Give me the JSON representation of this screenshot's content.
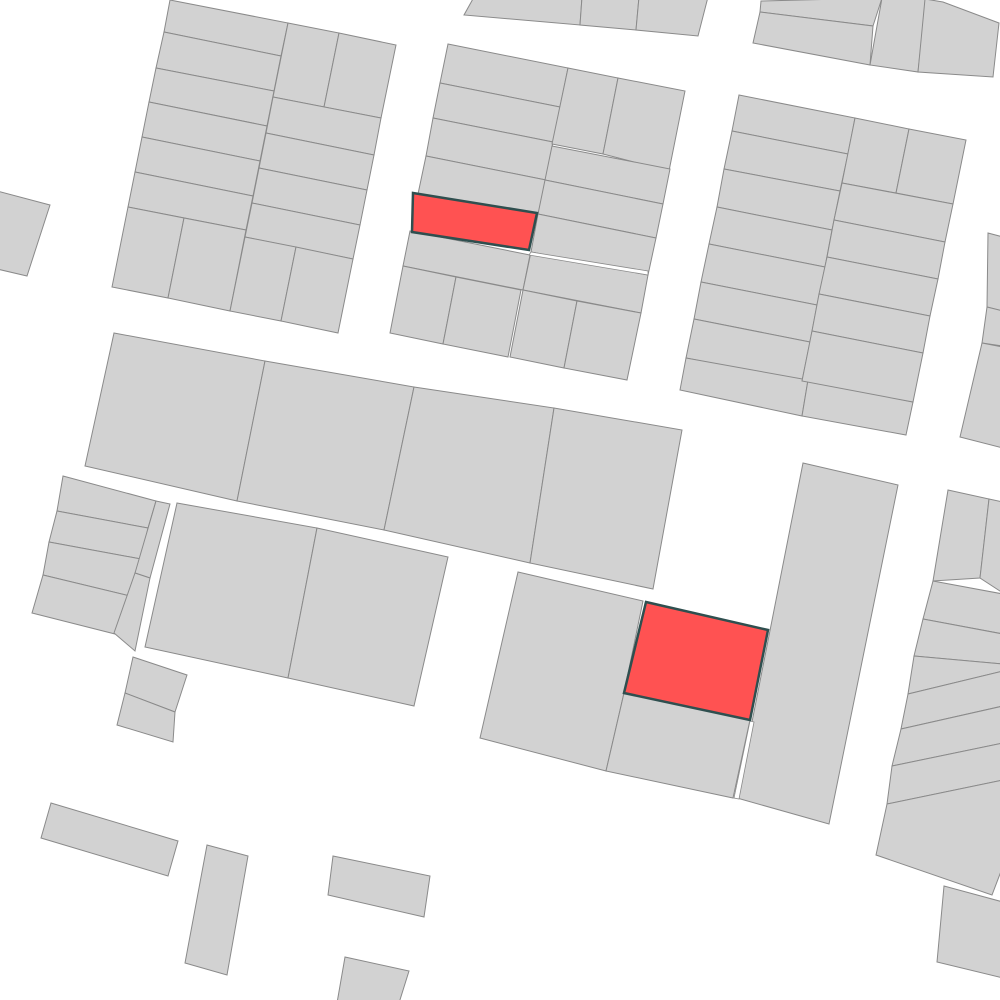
{
  "map": {
    "background": "#ffffff",
    "canvas": {
      "width": 1000,
      "height": 1000
    },
    "parcel_style": {
      "fill": "#d2d2d2",
      "stroke": "#8a8a8a",
      "stroke_width": 1
    },
    "highlight_style": {
      "fill": "#ff5252",
      "stroke": "#2f4f4f",
      "stroke_width": 2.5
    },
    "gap_style": {
      "fill": "#ffffff",
      "stroke": "#8a8a8a",
      "stroke_width": 0.8
    },
    "parcels": [
      {
        "points": "170,0 288,23 281,56 164,32"
      },
      {
        "points": "164,32 281,56 274,91 156,68"
      },
      {
        "points": "156,68 274,91 267,126 149,102"
      },
      {
        "points": "149,102 267,126 260,161 142,137"
      },
      {
        "points": "142,137 260,161 253,196 135,172"
      },
      {
        "points": "135,172 253,196 246,230 128,207"
      },
      {
        "points": "128,207 184,218 168,298 112,287"
      },
      {
        "points": "184,218 246,230 230,311 168,298"
      },
      {
        "points": "288,23 339,33 324,107 273,97"
      },
      {
        "points": "339,33 396,45 381,118 324,107"
      },
      {
        "points": "273,97 381,118 374,155 266,133"
      },
      {
        "points": "266,133 374,155 367,190 259,168"
      },
      {
        "points": "259,168 367,190 360,225 252,203"
      },
      {
        "points": "252,203 360,225 353,259 245,237"
      },
      {
        "points": "245,237 296,247 281,321 230,311"
      },
      {
        "points": "296,247 353,259 338,333 281,321"
      },
      {
        "points": "448,44 568,68 560,107 440,83"
      },
      {
        "points": "440,83 560,107 553,142 433,118"
      },
      {
        "points": "433,118 553,142 546,180 426,156"
      },
      {
        "points": "426,156 546,180 538,218 418,194"
      },
      {
        "points": "410,231 530,255 523,290 403,266"
      },
      {
        "points": "403,266 456,277 443,344 390,333"
      },
      {
        "points": "456,277 521,290 508,357 443,344"
      },
      {
        "points": "568,68 618,78 603,154 552,144"
      },
      {
        "points": "618,78 685,91 669,171 603,154"
      },
      {
        "points": "552,146 670,169 663,204 545,180"
      },
      {
        "points": "545,180 663,204 656,238 538,214"
      },
      {
        "points": "538,214 656,238 648,275 531,252"
      },
      {
        "points": "531,252 648,275 641,313 523,290"
      },
      {
        "points": "523,290 577,301 564,368 510,357"
      },
      {
        "points": "577,301 641,313 627,380 564,368"
      },
      {
        "points": "739,95 855,118 848,154 732,131"
      },
      {
        "points": "732,131 848,154 840,191 724,169"
      },
      {
        "points": "724,169 840,191 832,230 717,207"
      },
      {
        "points": "717,207 832,230 825,267 709,244"
      },
      {
        "points": "709,244 825,267 817,305 701,282"
      },
      {
        "points": "701,282 817,305 810,342 694,319"
      },
      {
        "points": "694,319 810,342 802,381 686,358"
      },
      {
        "points": "686,358 808,380 802,416 680,390"
      },
      {
        "points": "808,380 913,402 906,435 802,416"
      },
      {
        "points": "855,118 909,129 896,193 842,183"
      },
      {
        "points": "909,129 966,140 953,204 896,193"
      },
      {
        "points": "842,183 953,204 945,242 834,220"
      },
      {
        "points": "834,220 945,242 938,279 827,257"
      },
      {
        "points": "827,257 938,279 930,316 819,294"
      },
      {
        "points": "819,294 930,316 923,353 812,331"
      },
      {
        "points": "812,331 923,353 913,402 802,381"
      },
      {
        "points": "761,1 882,-2 873,26 760,12"
      },
      {
        "points": "760,12 873,26 870,65 753,43"
      },
      {
        "points": "882,-2 926,-2 918,72 870,65"
      },
      {
        "points": "925,-1 943,2 999,23 993,77 918,72"
      },
      {
        "points": "474,-3 582,-3 580,25 464,15"
      },
      {
        "points": "582,-3 639,-3 636,30 580,25"
      },
      {
        "points": "639,-3 708,-3 698,36 636,30"
      },
      {
        "points": "114,333 265,361 237,501 85,466"
      },
      {
        "points": "265,361 414,387 384,530 237,501"
      },
      {
        "points": "414,387 554,408 530,563 384,530"
      },
      {
        "points": "554,408 682,430 653,589 530,563"
      },
      {
        "points": "63,476 156,501 148,528 57,511"
      },
      {
        "points": "57,511 148,528 141,559 49,542"
      },
      {
        "points": "49,542 141,559 130,596 43,575"
      },
      {
        "points": "43,575 130,596 115,634 32,613"
      },
      {
        "points": "156,501 170,504 150,578 135,573"
      },
      {
        "points": "135,573 150,578 135,651 114,633"
      },
      {
        "points": "177,503 317,528 288,678 145,647"
      },
      {
        "points": "317,528 448,557 414,706 288,678"
      },
      {
        "points": "133,657 187,675 175,712 125,693"
      },
      {
        "points": "125,693 175,712 173,742 117,725"
      },
      {
        "points": "-3,191 50,205 27,276 -3,269"
      },
      {
        "points": "518,572 643,601 624,693 606,771 480,738"
      },
      {
        "points": "624,693 750,720 733,798 606,771"
      },
      {
        "points": "803,463 898,485 829,824 737,798"
      },
      {
        "points": "948,490 989,499 980,578 933,581"
      },
      {
        "points": "989,499 1003,502 1003,593 980,578"
      },
      {
        "points": "933,581 1003,594 1003,634 923,619"
      },
      {
        "points": "923,619 1003,634 1003,664 914,656"
      },
      {
        "points": "914,656 1003,664 1003,671 908,694"
      },
      {
        "points": "908,694 1003,671 1003,706 901,729"
      },
      {
        "points": "901,729 1003,706 1003,743 892,766"
      },
      {
        "points": "892,766 1003,743 1003,780 887,804"
      },
      {
        "points": "887,804 1003,780 1003,866 992,895 876,855"
      },
      {
        "points": "988,233 1003,237 1003,311 987,307"
      },
      {
        "points": "987,307 1003,311 1003,346 982,343"
      },
      {
        "points": "982,343 1003,347 1003,448 960,437"
      },
      {
        "points": "944,886 1003,902 1003,978 937,962"
      },
      {
        "points": "51,803 178,841 168,876 41,838"
      },
      {
        "points": "207,845 248,856 227,975 185,963"
      },
      {
        "points": "333,856 430,876 424,917 328,895"
      },
      {
        "points": "345,957 409,971 399,1003 337,1003"
      }
    ],
    "gap_slivers": [
      {
        "points": "531,252 648,271 648,275 529,255"
      },
      {
        "points": "750,721 754,722 739,799 734,798"
      }
    ],
    "highlighted_parcels": [
      {
        "points": "413,193 537,213 529,250 412,232"
      },
      {
        "points": "646,602 768,630 750,720 624,693"
      }
    ]
  }
}
